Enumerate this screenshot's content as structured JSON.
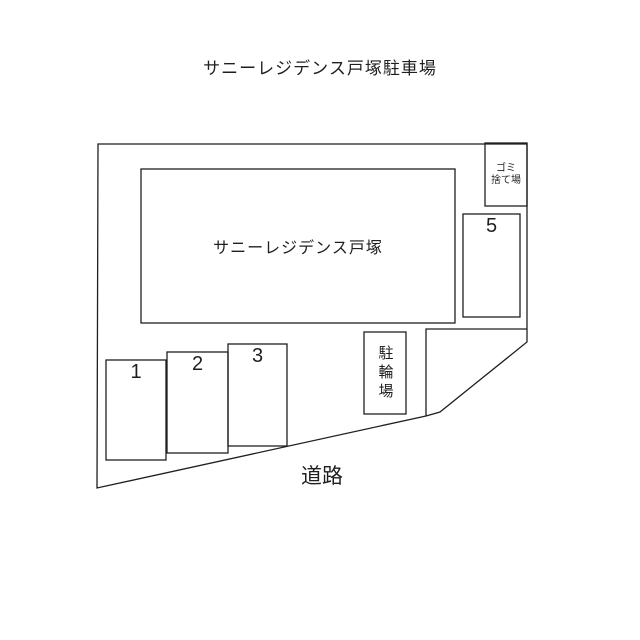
{
  "page": {
    "title": "サニーレジデンス戸塚駐車場"
  },
  "map": {
    "building_label": "サニーレジデンス戸塚",
    "road_label": "道路",
    "bicycle_parking_label": "駐輪場",
    "garbage_area_label": "ゴミ\n捨て場",
    "spaces": [
      {
        "number": "1"
      },
      {
        "number": "2"
      },
      {
        "number": "3"
      },
      {
        "number": "5"
      }
    ],
    "line_color": "#1f1f1f",
    "background_color": "#ffffff"
  }
}
